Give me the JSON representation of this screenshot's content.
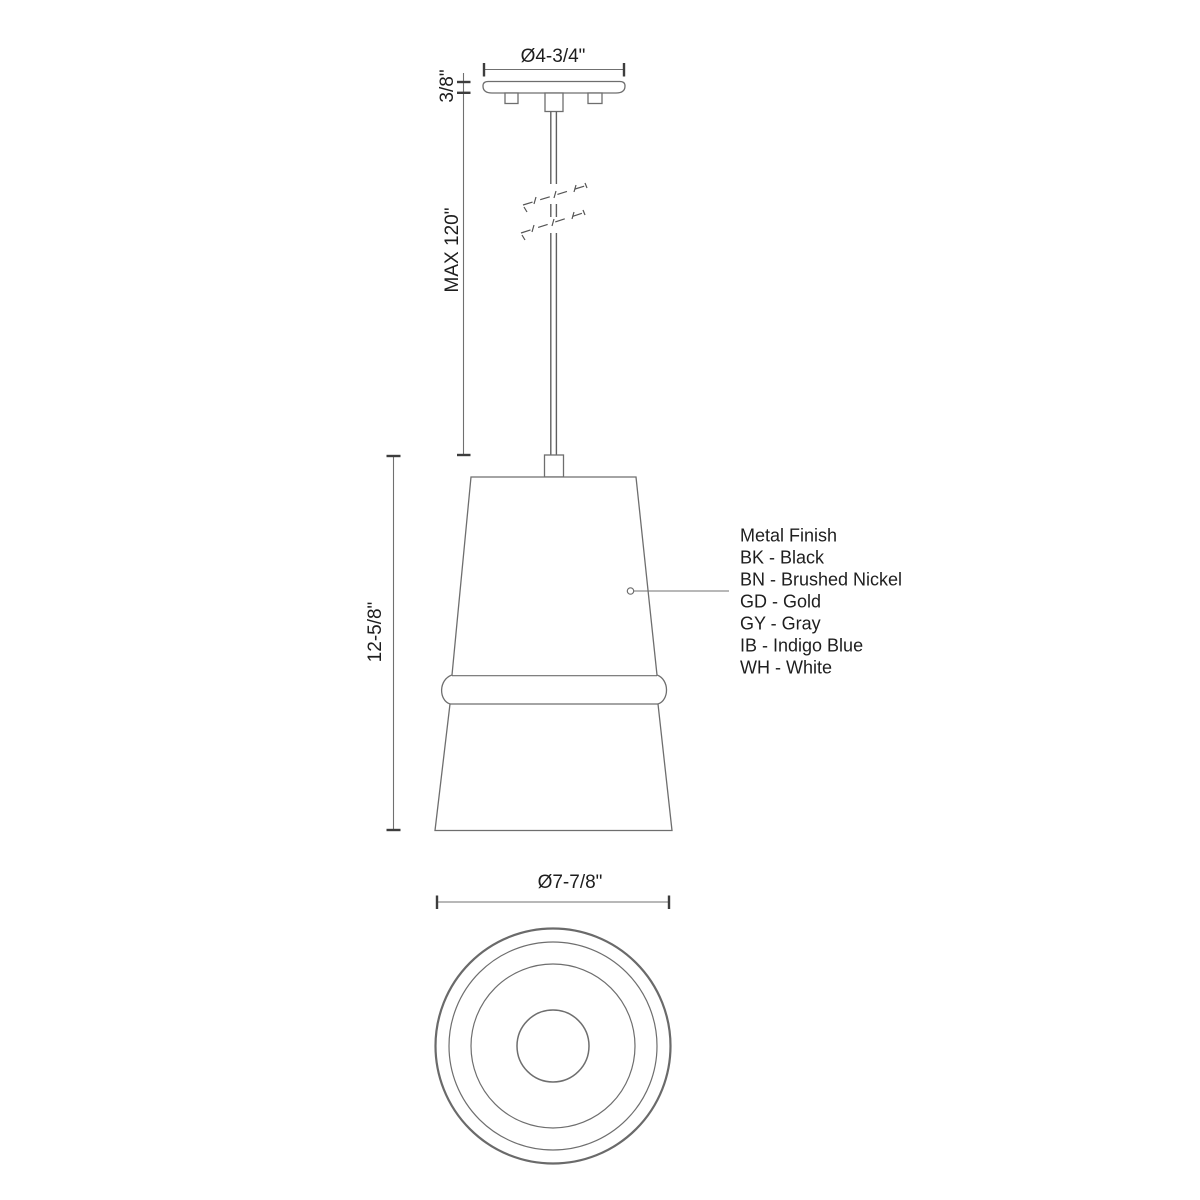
{
  "canvas": {
    "background": "#ffffff"
  },
  "palette": {
    "line": "#6e6e6e",
    "outer_circle_line": "#6a6a6a",
    "tick": "#3d3d3d",
    "text": "#1e1e1e"
  },
  "front_view": {
    "canopy_diameter_label": "Ø4-3/4\"",
    "canopy_height_label": "3/8\"",
    "max_drop_label": "MAX 120\"",
    "shade_height_label": "12-5/8\""
  },
  "bottom_view": {
    "shade_diameter_label": "Ø7-7/8\""
  },
  "finish_legend": {
    "title": "Metal Finish",
    "options": [
      "BK - Black",
      "BN - Brushed Nickel",
      "GD - Gold",
      "GY - Gray",
      "IB - Indigo Blue",
      "WH - White"
    ]
  }
}
